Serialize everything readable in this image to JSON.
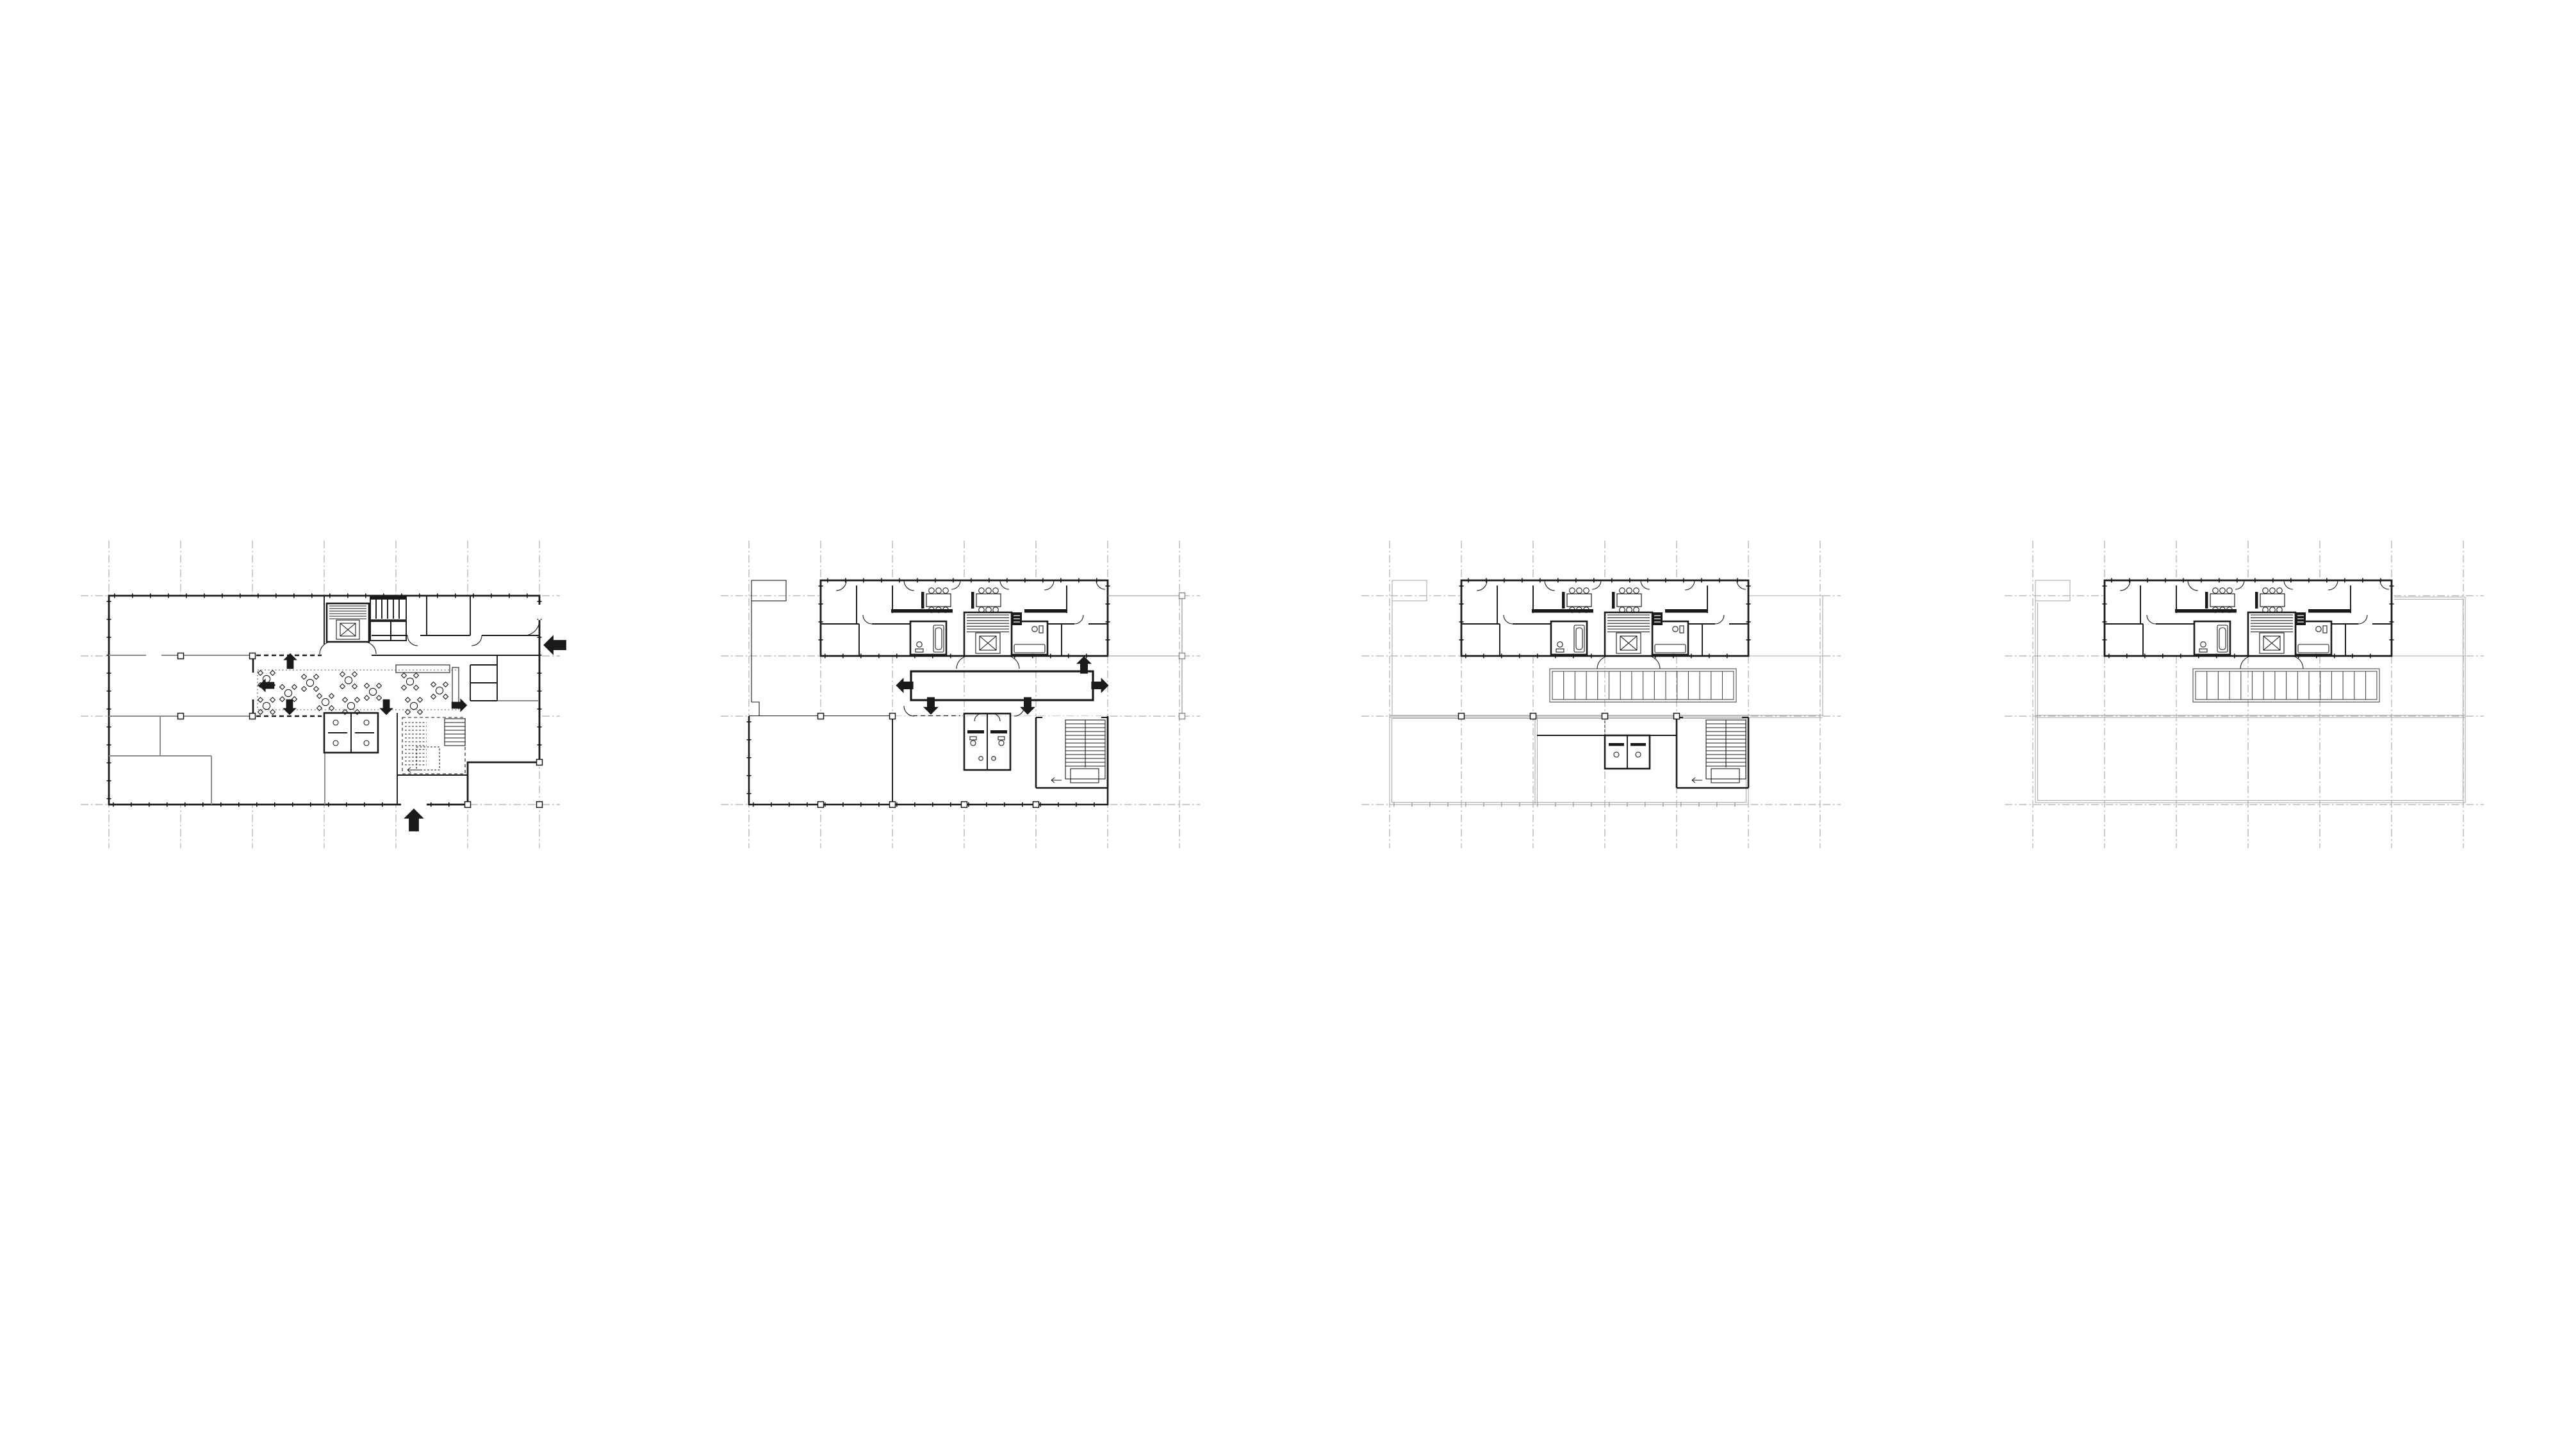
{
  "page": {
    "background": "#ffffff"
  },
  "palette": {
    "ink": "#1a1a1a",
    "mid_gray_wall": "#8c8c8c",
    "light_roof_line": "#a9a9a9",
    "grid_line": "#9a9a9a",
    "skylight_line": "#4a4a4a"
  },
  "sheet": {
    "figure_type": "architectural floor plan series",
    "plan_count": 4,
    "plans": [
      {
        "id": "plan-1",
        "aria_label": "floor plan level 1 - entry level with lobby seating, cafe tables and entrance arrows"
      },
      {
        "id": "plan-2",
        "aria_label": "floor plan level 2 - apartment bar with central double-height void and directional arrows"
      },
      {
        "id": "plan-3",
        "aria_label": "floor plan level 3 - apartment bar with linear skylight, partially enclosed lower block"
      },
      {
        "id": "plan-4",
        "aria_label": "floor plan level 4 - apartment bar with linear skylight over roof outline"
      }
    ]
  }
}
